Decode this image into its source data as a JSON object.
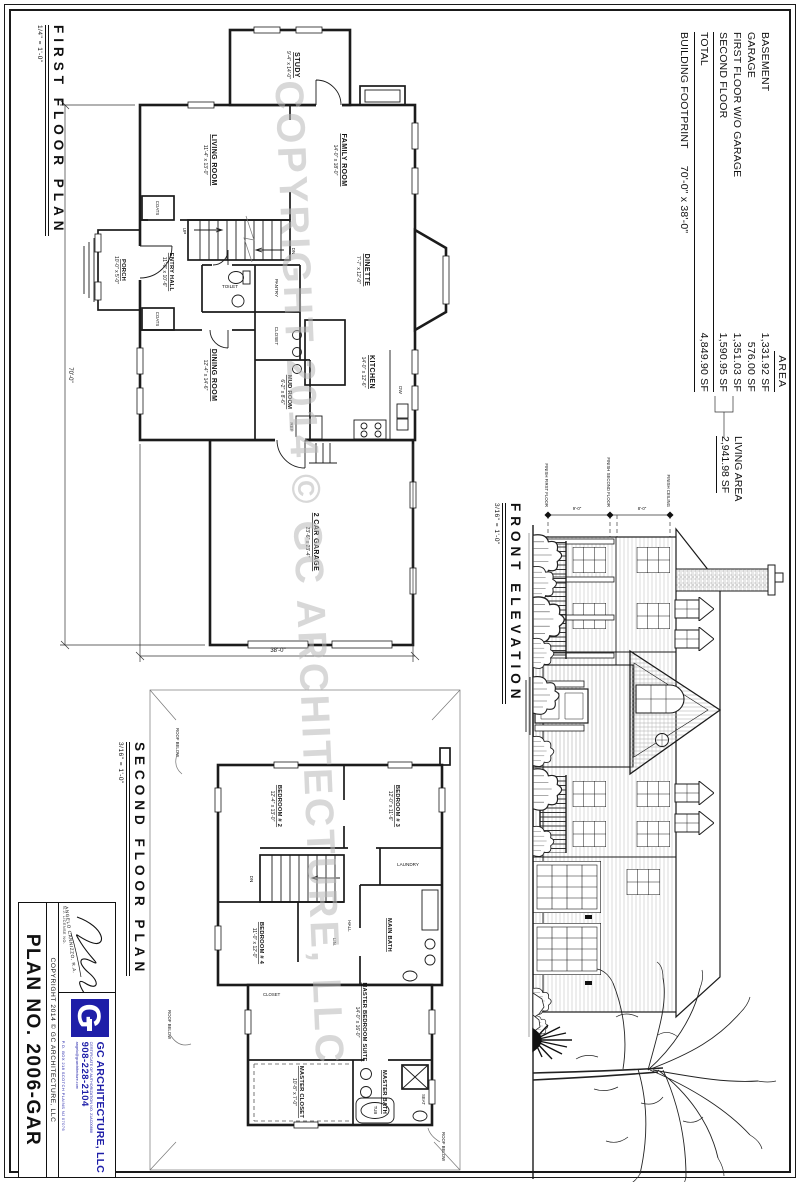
{
  "sheet": {
    "watermark": "COPYRIGHT 2014 © GC ARCHITECTURE, LLC"
  },
  "area_table": {
    "header": "AREA",
    "rows": [
      {
        "label": "BASEMENT",
        "value": "1,331.92 SF"
      },
      {
        "label": "GARAGE",
        "value": "576.00 SF"
      },
      {
        "label": "FIRST FLOOR W/O GARAGE",
        "value": "1,351.03 SF"
      },
      {
        "label": "SECOND FLOOR",
        "value": "1,590.95 SF"
      }
    ],
    "total_label": "TOTAL",
    "total_value": "4,849.90 SF",
    "footprint_label": "BUILDING FOOTPRINT",
    "footprint_value": "70'-0\" x 38'-0\"",
    "living_area_label": "LIVING AREA",
    "living_area_value": "2,941.98 SF"
  },
  "first_floor": {
    "title": "FIRST FLOOR PLAN",
    "scale": "1/4\" = 1'-0\"",
    "dim_width": "70'-0\"",
    "dim_depth": "38'-0\"",
    "stairs_up": "UP",
    "stairs_dn": "DN",
    "rooms": {
      "study": {
        "name": "STUDY",
        "dims": "9'-4\" x 14'-0\""
      },
      "family": {
        "name": "FAMILY ROOM",
        "dims": "14'-0\" x 18'-0\""
      },
      "living": {
        "name": "LIVING ROOM",
        "dims": "11'-4\" x 13'-0\""
      },
      "entry": {
        "name": "ENTRY HALL",
        "dims": "11'-0\" x 10'-6\""
      },
      "porch": {
        "name": "PORCH",
        "dims": "10'-0\" x 5'-0\""
      },
      "dinette": {
        "name": "DINETTE",
        "dims": "7'-7\" x 12'-0\""
      },
      "kitchen": {
        "name": "KITCHEN",
        "dims": "14'-0\" x 12'-6\""
      },
      "dining": {
        "name": "DINING ROOM",
        "dims": "12'-4\" x 14'-6\""
      },
      "mud": {
        "name": "MUD ROOM",
        "dims": "6'-2\" x 8'-6\""
      },
      "toilet": {
        "name": "TOILET"
      },
      "pantry": {
        "name": "PANTRY"
      },
      "closet": {
        "name": "CLOSET"
      },
      "coats": {
        "name": "COATS"
      },
      "garage": {
        "name": "2 CAR GARAGE",
        "dims": "23'-6\" x 23'-4\""
      }
    },
    "appliances": {
      "dw": "DW",
      "ref": "REF"
    }
  },
  "second_floor": {
    "title": "SECOND FLOOR PLAN",
    "scale": "3/16\" = 1'-0\"",
    "stairs_dn": "DN",
    "roof_below": "ROOF BELOW",
    "rooms": {
      "bed2": {
        "name": "BEDROOM # 2",
        "dims": "12'-4\" x 13'-0\""
      },
      "bed3": {
        "name": "BEDROOM # 3",
        "dims": "12'-0\" x 11'-6\""
      },
      "bed4": {
        "name": "BEDROOM # 4",
        "dims": "11'-0\" x 12'-0\""
      },
      "laundry": {
        "name": "LAUNDRY"
      },
      "hall": {
        "name": "HALL"
      },
      "main_bath": {
        "name": "MAIN BATH"
      },
      "master": {
        "name": "MASTER BEDROOM SUITE",
        "dims": "14'-0\" x 16'-0\""
      },
      "m_closet": {
        "name": "MASTER CLOSET",
        "dims": "10'-8\" x 7'-0\""
      },
      "m_bath": {
        "name": "MASTER BATH",
        "dims": "10'-8\" x 9'-0\""
      },
      "lin": {
        "name": "LIN."
      },
      "closet": {
        "name": "CLOSET"
      },
      "tub": {
        "name": "TUB"
      },
      "seat": {
        "name": "SEAT"
      }
    }
  },
  "elevation": {
    "title": "FRONT ELEVATION",
    "scale": "3/16\" = 1'-0\"",
    "dims": [
      "9'-0\"",
      "8'-0\""
    ],
    "levels": [
      "FINISH FIRST FLOOR",
      "FINISH SECOND FLOOR",
      "FINISH CEILING"
    ]
  },
  "titleblock": {
    "plan_no": "PLAN NO. 2006-GAR",
    "copyright": "COPYRIGHT 2014 © GC ARCHITECTURE, LLC",
    "architect_name": "ANGELO CANNIZZO, R.A.",
    "license": "N.J. LICENSE NO.",
    "logo_letter": "G",
    "firm_name": "GC ARCHITECTURE, LLC",
    "cert_line": "CERTIFICATE OF AUTHORIZATION NO. 21AC00888",
    "phone": "908-228-2104",
    "email": "angelo@gcarchitecture.com",
    "address": "P.O. BOX 218  SCOTCH PLAINS NJ 07076"
  }
}
